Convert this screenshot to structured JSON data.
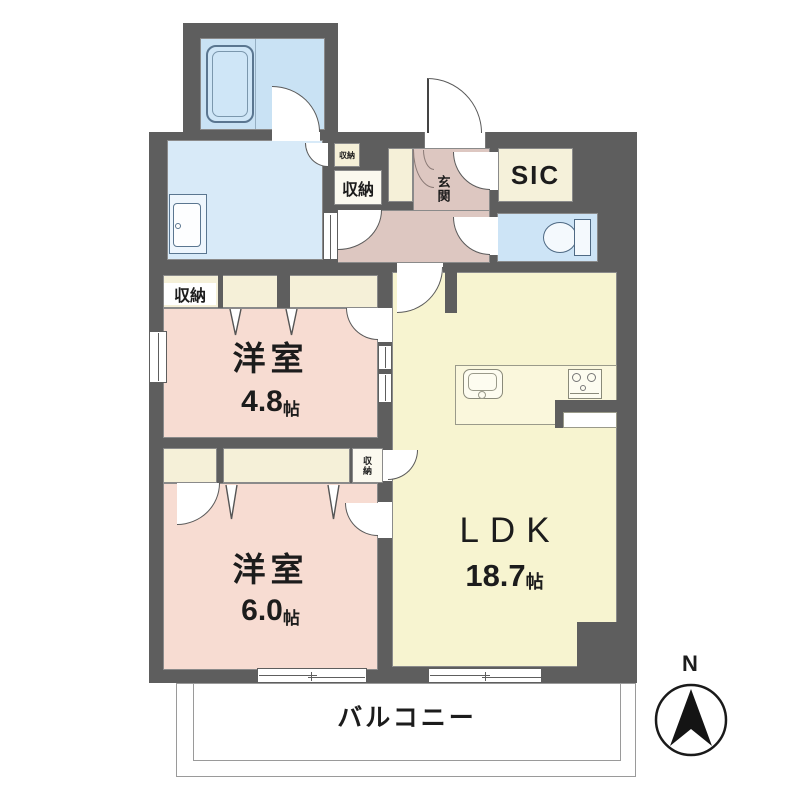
{
  "floor_plan": {
    "compass": {
      "north_label": "N"
    },
    "rooms": {
      "ldk": {
        "label": "LDK",
        "area_value": "18.7",
        "area_unit": "帖"
      },
      "western_room_small": {
        "label": "洋室",
        "area_value": "4.8",
        "area_unit": "帖"
      },
      "western_room_large": {
        "label": "洋室",
        "area_value": "6.0",
        "area_unit": "帖"
      },
      "entrance": {
        "label": "玄関"
      },
      "shoe_in_closet": {
        "label": "SIC"
      },
      "balcony": {
        "label": "バルコニー"
      }
    },
    "storage": {
      "hall_closet_label": "収納",
      "hall_closet_small_label": "収納",
      "bedroom_closet_label": "収納",
      "ldk_side_closet_label": "収納"
    },
    "colors": {
      "wall": "#5e5e5e",
      "bedroom_pink": "#f7dcd2",
      "ldk_cream": "#f7f4d0",
      "closet_cream": "#f5f0d8",
      "bathroom_blue": "#c9e2f4",
      "washroom_blue": "#d8eaf8",
      "toilet_blue": "#cde4f6",
      "hallway_pink": "#ddc7c1"
    }
  }
}
